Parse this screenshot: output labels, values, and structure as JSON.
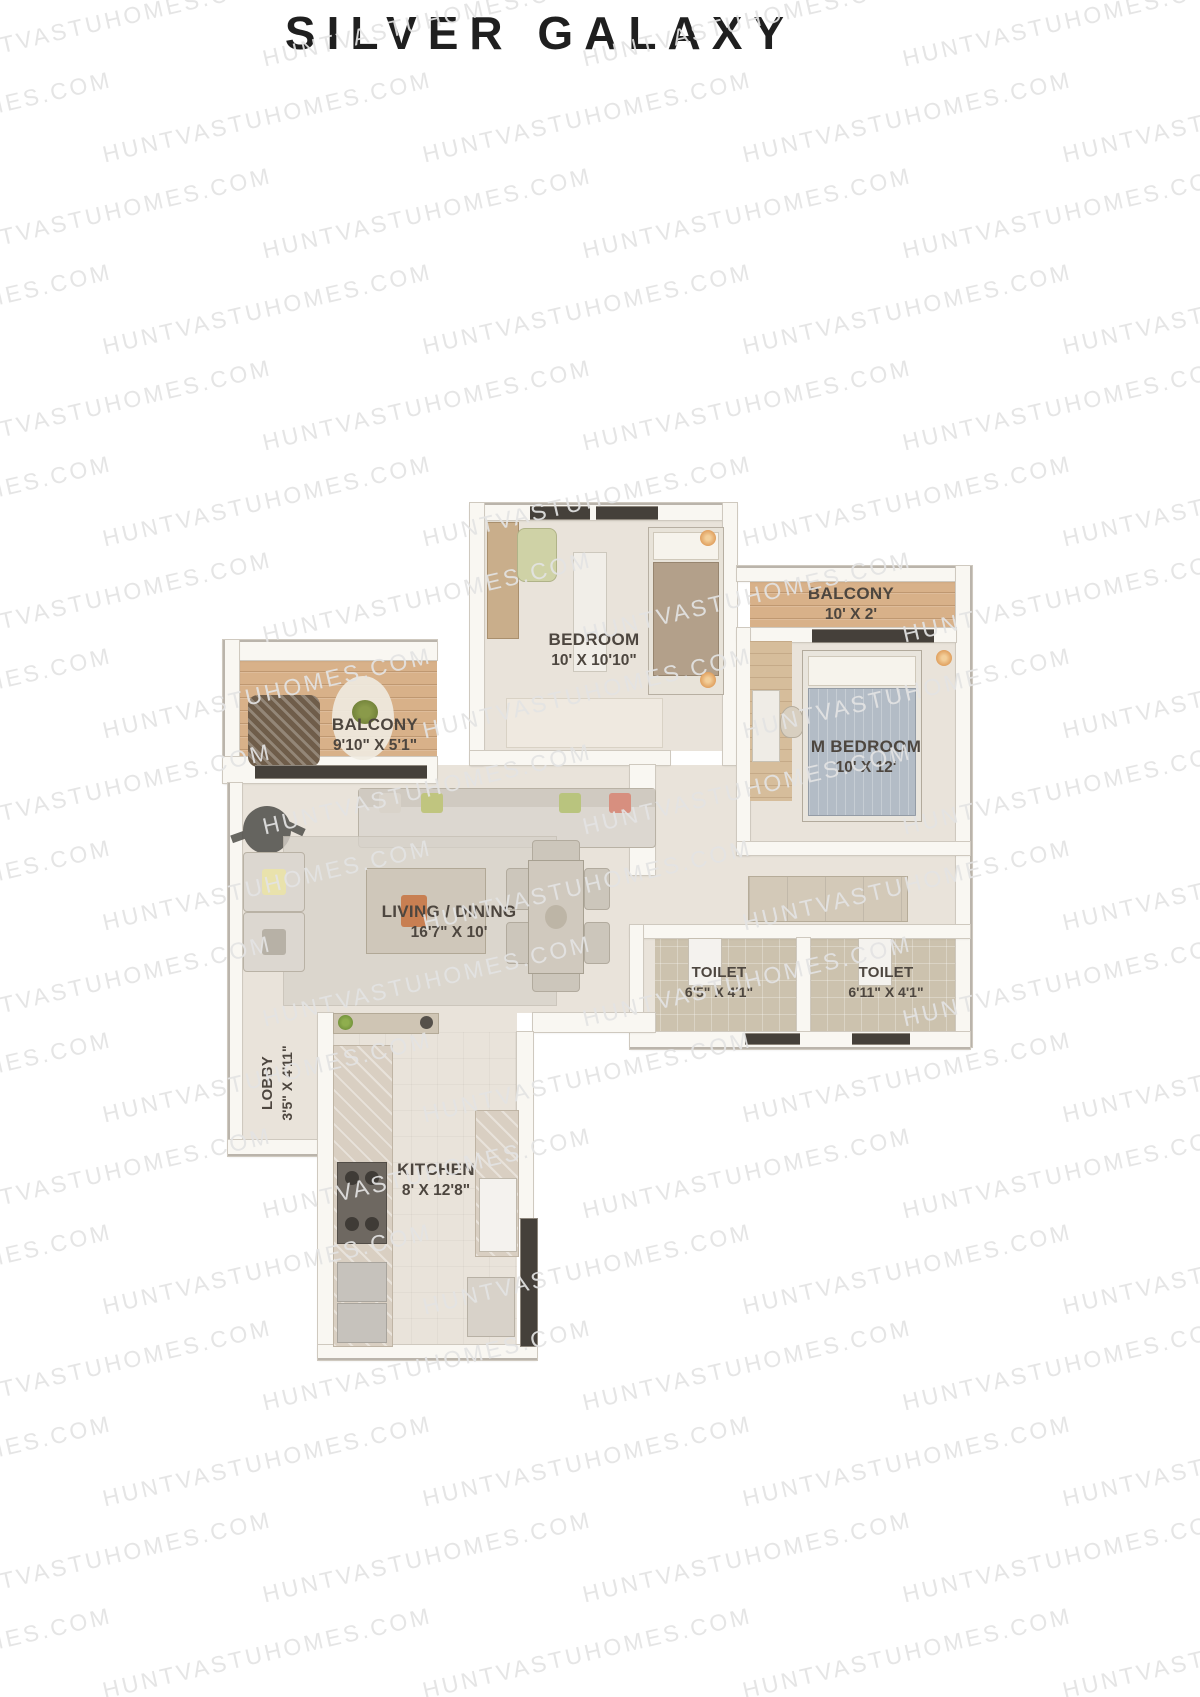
{
  "title": "SILVER GALAXY",
  "watermark": {
    "text": "HUNTVASTUHOMES.COM"
  },
  "rooms": {
    "bedroom": {
      "name": "BEDROOM",
      "dims": "10' X 10'10\""
    },
    "balcony_top": {
      "name": "BALCONY",
      "dims": "10' X 2'"
    },
    "m_bedroom": {
      "name": "M BEDROOM",
      "dims": "10' X 12'"
    },
    "balcony_left": {
      "name": "BALCONY",
      "dims": "9'10\" X 5'1\""
    },
    "living_dining": {
      "name": "LIVING / DINING",
      "dims": "16'7\" X 10'"
    },
    "toilet_left": {
      "name": "TOILET",
      "dims": "6'5\" X 4'1\""
    },
    "toilet_right": {
      "name": "TOILET",
      "dims": "6'11\" X 4'1\""
    },
    "lobby": {
      "name": "LOBBY",
      "dims": "3'5\" X 4'11\""
    },
    "kitchen": {
      "name": "KITCHEN",
      "dims": "8' X 12'8\""
    }
  },
  "colors": {
    "title-color": "#1f1f1f",
    "watermark-color": "rgba(227,227,227,0.92)",
    "wall": "#f9f7f2",
    "wall-line": "#cfc9bf",
    "floor": "#e9e3da",
    "wood": "#d8b189",
    "tile": "#ccc2ae",
    "marble": "#d9cfc2",
    "window-dark": "#45403a",
    "label": "#4d463f",
    "accent-orange": "#e0a05f"
  }
}
